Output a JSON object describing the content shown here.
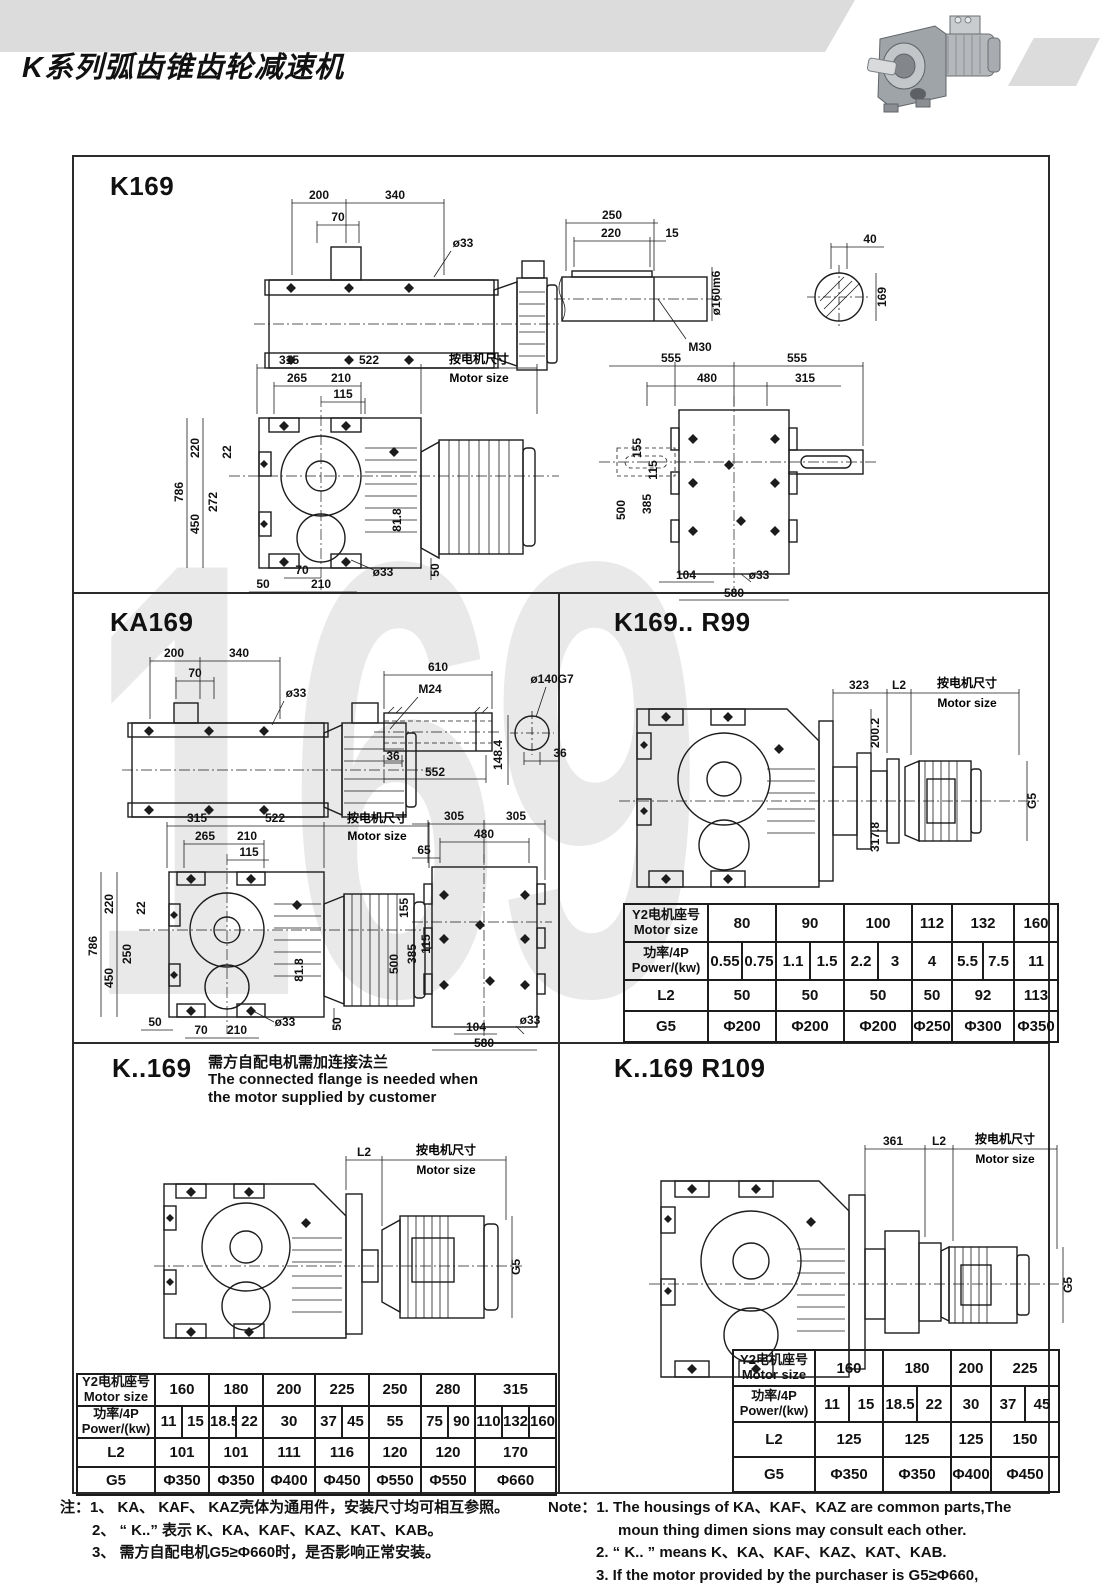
{
  "header": {
    "title": "K系列弧齿锥齿轮减速机"
  },
  "watermark": "169",
  "k169": {
    "title": "K169",
    "side": {
      "d200": "200",
      "d340": "340",
      "d70": "70",
      "d33": "ø33"
    },
    "shaft": {
      "d250": "250",
      "d220": "220",
      "d15": "15",
      "d160": "ø160m6",
      "m30": "M30",
      "d40": "40",
      "d169": "169"
    },
    "front": {
      "d315": "315",
      "d522": "522",
      "msz_zh": "按电机尺寸",
      "msz_en": "Motor size",
      "d265": "265",
      "d210": "210",
      "d115": "115",
      "d786": "786",
      "d220": "220",
      "d22": "22",
      "d272": "272",
      "d450": "450",
      "d818": "81.8",
      "d70": "70",
      "d50a": "50",
      "d210b": "210",
      "d33": "ø33",
      "d50b": "50"
    },
    "top": {
      "d555a": "555",
      "d555b": "555",
      "d480": "480",
      "d315": "315",
      "d155": "155",
      "d115": "115",
      "d385": "385",
      "d500": "500",
      "d104": "104",
      "d33": "ø33",
      "d580": "580"
    }
  },
  "ka169": {
    "title": "KA169",
    "side": {
      "d200": "200",
      "d340": "340",
      "d70": "70",
      "d33": "ø33"
    },
    "shaft": {
      "d610": "610",
      "m24": "M24",
      "d36a": "36",
      "d552": "552",
      "d140": "ø140G7",
      "d36b": "36",
      "d1484": "148.4"
    },
    "front": {
      "d315": "315",
      "d522": "522",
      "msz_zh": "按电机尺寸",
      "msz_en": "Motor size",
      "d265": "265",
      "d210": "210",
      "d115": "115",
      "d786": "786",
      "d220": "220",
      "d22": "22",
      "d250": "250",
      "d450": "450",
      "d818": "81.8",
      "d50a": "50",
      "d70": "70",
      "d210b": "210",
      "d33": "ø33",
      "d50b": "50"
    },
    "top": {
      "d305a": "305",
      "d305b": "305",
      "d480": "480",
      "d65": "65",
      "d155": "155",
      "d385": "385",
      "d115": "115",
      "d500": "500",
      "d104": "104",
      "d33": "ø33",
      "d580": "580"
    }
  },
  "r99": {
    "title": "K169..  R99",
    "dims": {
      "d323": "323",
      "l2": "L2",
      "msz_zh": "按电机尺寸",
      "msz_en": "Motor size",
      "d2002": "200.2",
      "d3178": "317.8",
      "g5": "G5"
    }
  },
  "kcustom": {
    "title": "K..169",
    "note_zh": "需方自配电机需加连接法兰",
    "note_en1": "The connected flange is needed when",
    "note_en2": "the motor supplied by customer",
    "dims": {
      "l2": "L2",
      "msz_zh": "按电机尺寸",
      "msz_en": "Motor size",
      "g5": "G5"
    }
  },
  "r109": {
    "title": "K..169  R109",
    "dims": {
      "d361": "361",
      "l2": "L2",
      "msz_zh": "按电机尺寸",
      "msz_en": "Motor size",
      "g5": "G5"
    }
  },
  "tables": {
    "header_zh": "Y2电机座号",
    "header_en": "Motor size",
    "power_zh": "功率/4P",
    "power_en": "Power/(kw)",
    "l2_label": "L2",
    "g5_label": "G5",
    "r99": {
      "sizes": [
        "80",
        "90",
        "100",
        "112",
        "132",
        "160"
      ],
      "power": [
        "0.55",
        "0.75",
        "1.1",
        "1.5",
        "2.2",
        "3",
        "4",
        "5.5",
        "7.5",
        "11"
      ],
      "l2": [
        "50",
        "50",
        "50",
        "50",
        "92",
        "113"
      ],
      "g5": [
        "Φ200",
        "Φ200",
        "Φ200",
        "Φ250",
        "Φ300",
        "Φ350"
      ]
    },
    "kcustom": {
      "sizes": [
        "160",
        "180",
        "200",
        "225",
        "250",
        "280",
        "315"
      ],
      "power": [
        "11",
        "15",
        "18.5",
        "22",
        "30",
        "37",
        "45",
        "55",
        "75",
        "90",
        "110",
        "132",
        "160"
      ],
      "l2": [
        "101",
        "101",
        "111",
        "116",
        "120",
        "120",
        "170"
      ],
      "g5": [
        "Φ350",
        "Φ350",
        "Φ400",
        "Φ450",
        "Φ550",
        "Φ550",
        "Φ660"
      ]
    },
    "r109": {
      "sizes": [
        "160",
        "180",
        "200",
        "225"
      ],
      "power": [
        "11",
        "15",
        "18.5",
        "22",
        "30",
        "37",
        "45"
      ],
      "l2": [
        "125",
        "125",
        "125",
        "150"
      ],
      "g5": [
        "Φ350",
        "Φ350",
        "Φ400",
        "Φ450"
      ]
    }
  },
  "notes": {
    "zh1": "注：1、 KA、 KAF、 KAZ壳体为通用件，安装尺寸均可相互参照。",
    "zh2": "2、 “ K..” 表示 K、KA、KAF、KAZ、KAT、KAB。",
    "zh3": "3、 需方自配电机G5≥Φ660时，是否影响正常安装。",
    "en1": "Note：1.  The housings of KA、KAF、KAZ are common parts,The",
    "en1b": "moun thing dimen sions may consult each other.",
    "en2": "2. “ K.. ”  means K、KA、KAF、KAZ、KAT、KAB.",
    "en3": "3.  If the motor provided by the purchaser is G5≥Φ660,",
    "en3b": "please check if normal installation is influenced."
  }
}
